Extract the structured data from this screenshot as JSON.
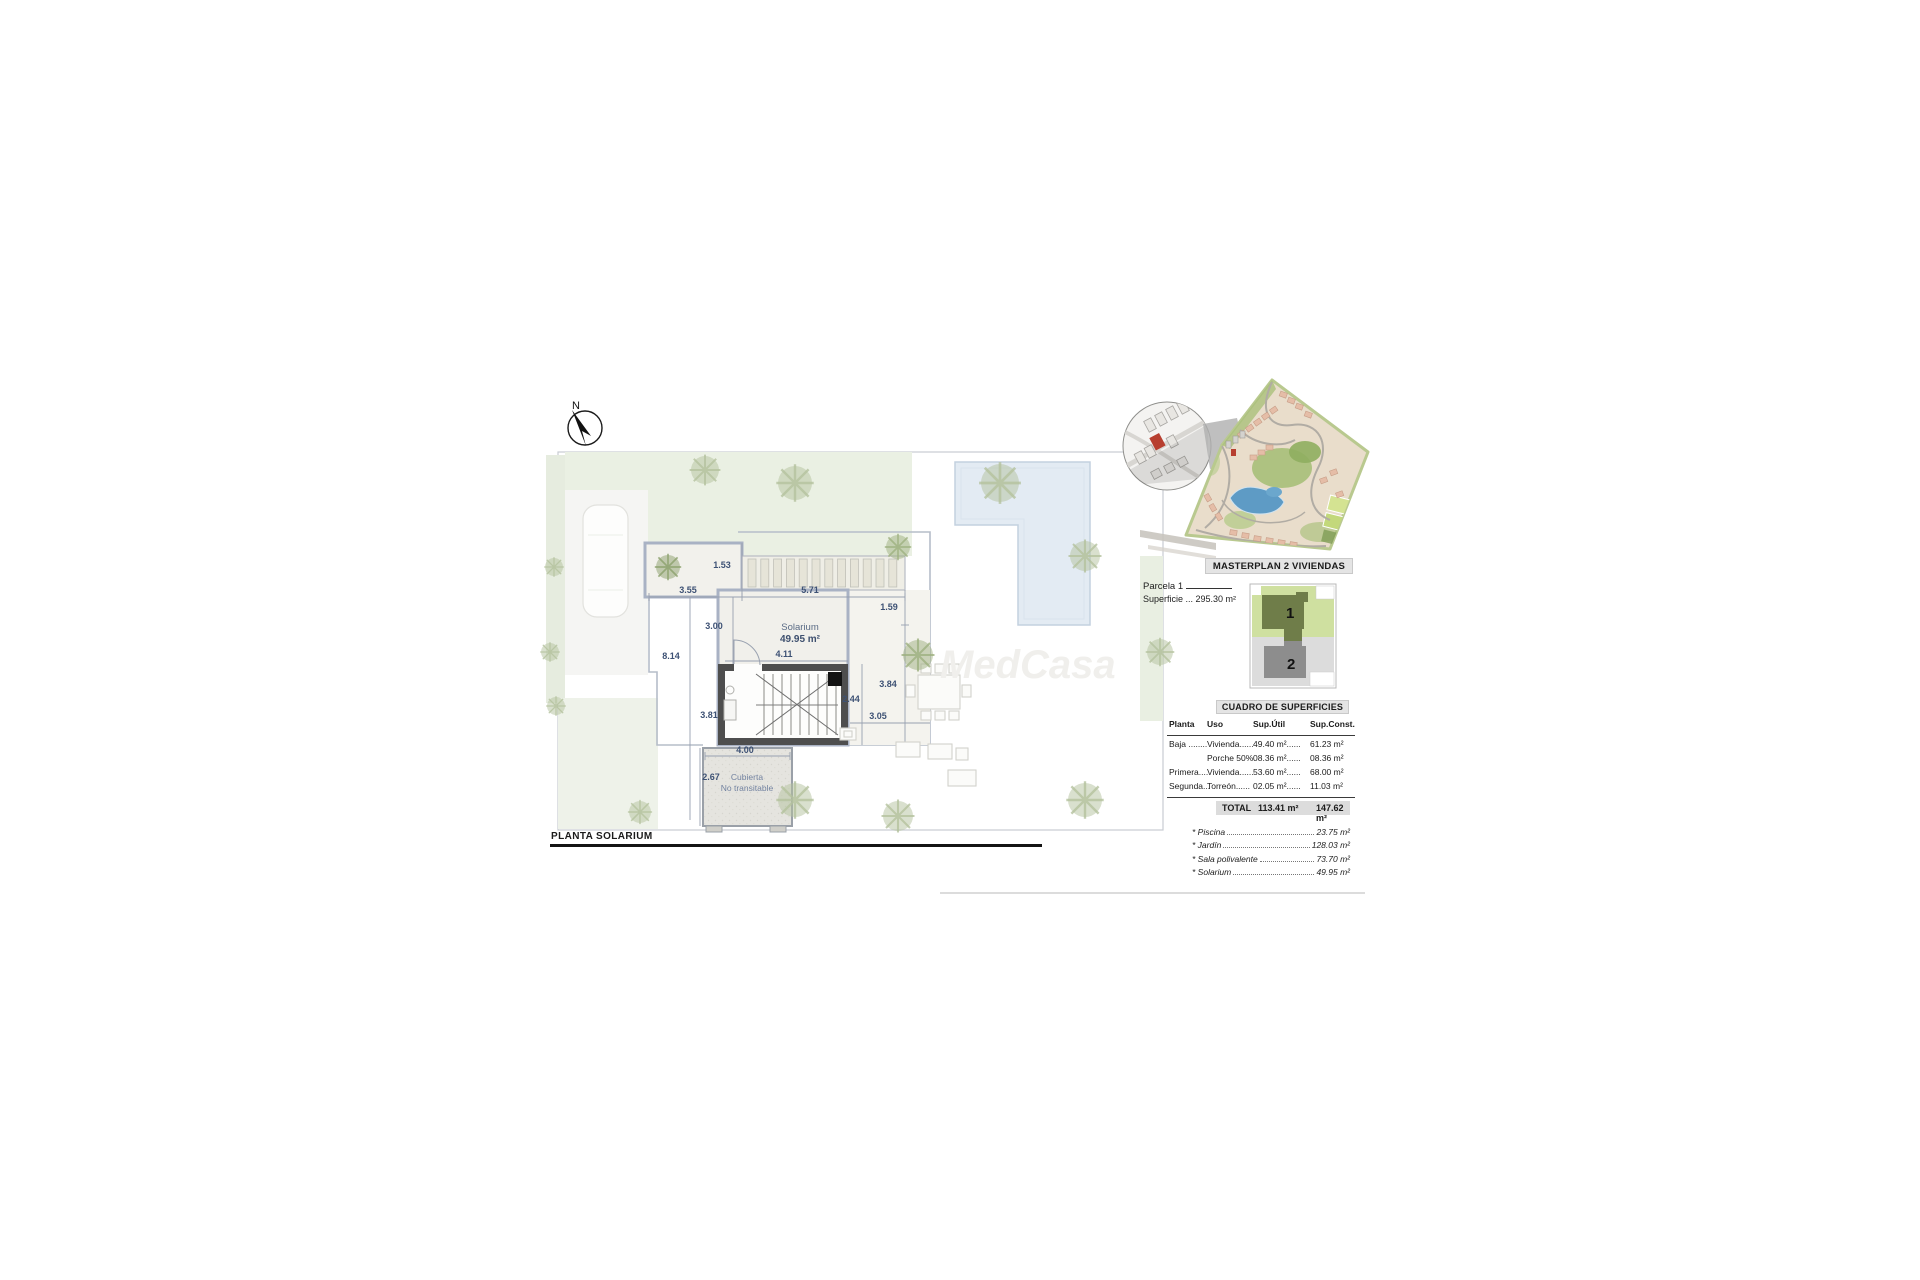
{
  "compass": {
    "label": "N"
  },
  "plan": {
    "title": "PLANTA SOLARIUM",
    "watermark": "MedCasa",
    "solarium": {
      "name": "Solarium",
      "area": "49.95 m²"
    },
    "cubierta": {
      "line1": "Cubierta",
      "line2": "No transitable"
    },
    "dimensions": [
      {
        "label": "1.53",
        "x": 722,
        "y": 568
      },
      {
        "label": "3.55",
        "x": 688,
        "y": 593
      },
      {
        "label": "5.71",
        "x": 810,
        "y": 593
      },
      {
        "label": "1.59",
        "x": 889,
        "y": 610
      },
      {
        "label": "3.00",
        "x": 714,
        "y": 629
      },
      {
        "label": "8.14",
        "x": 671,
        "y": 659
      },
      {
        "label": "4.11",
        "x": 784,
        "y": 657
      },
      {
        "label": "3.84",
        "x": 888,
        "y": 687
      },
      {
        "label": "2.44",
        "x": 851,
        "y": 702
      },
      {
        "label": "3.05",
        "x": 878,
        "y": 719
      },
      {
        "label": "3.81",
        "x": 709,
        "y": 718
      },
      {
        "label": "4.00",
        "x": 745,
        "y": 753
      },
      {
        "label": "2.67",
        "x": 711,
        "y": 780
      }
    ]
  },
  "masterplan": {
    "title": "MASTERPLAN 2 VIVIENDAS"
  },
  "parcela": {
    "name": "Parcela 1",
    "superficie": "Superficie ... 295.30 m²",
    "unit1": "1",
    "unit2": "2"
  },
  "cuadro": {
    "title": "CUADRO DE SUPERFICIES",
    "headers": [
      "Planta",
      "Uso",
      "Sup.Útil",
      "Sup.Const."
    ],
    "rows": [
      [
        "Baja ........",
        "Vivienda......",
        "49.40 m²......",
        "61.23 m²"
      ],
      [
        "",
        "Porche 50%",
        "08.36 m²......",
        "08.36 m²"
      ],
      [
        "Primera....",
        "Vivienda......",
        "53.60 m²......",
        "68.00 m²"
      ],
      [
        "Segunda...",
        "Torreón......",
        "02.05 m²......",
        "11.03 m²"
      ]
    ],
    "total": {
      "label": "TOTAL",
      "sup_util": "113.41 m²",
      "sup_const": "147.62 m²"
    }
  },
  "extras": [
    {
      "label": "* Piscina",
      "value": "23.75 m²"
    },
    {
      "label": "* Jardín",
      "value": "128.03 m²"
    },
    {
      "label": "* Sala polivalente",
      "value": "73.70 m²"
    },
    {
      "label": "* Solarium",
      "value": "49.95 m²"
    }
  ]
}
